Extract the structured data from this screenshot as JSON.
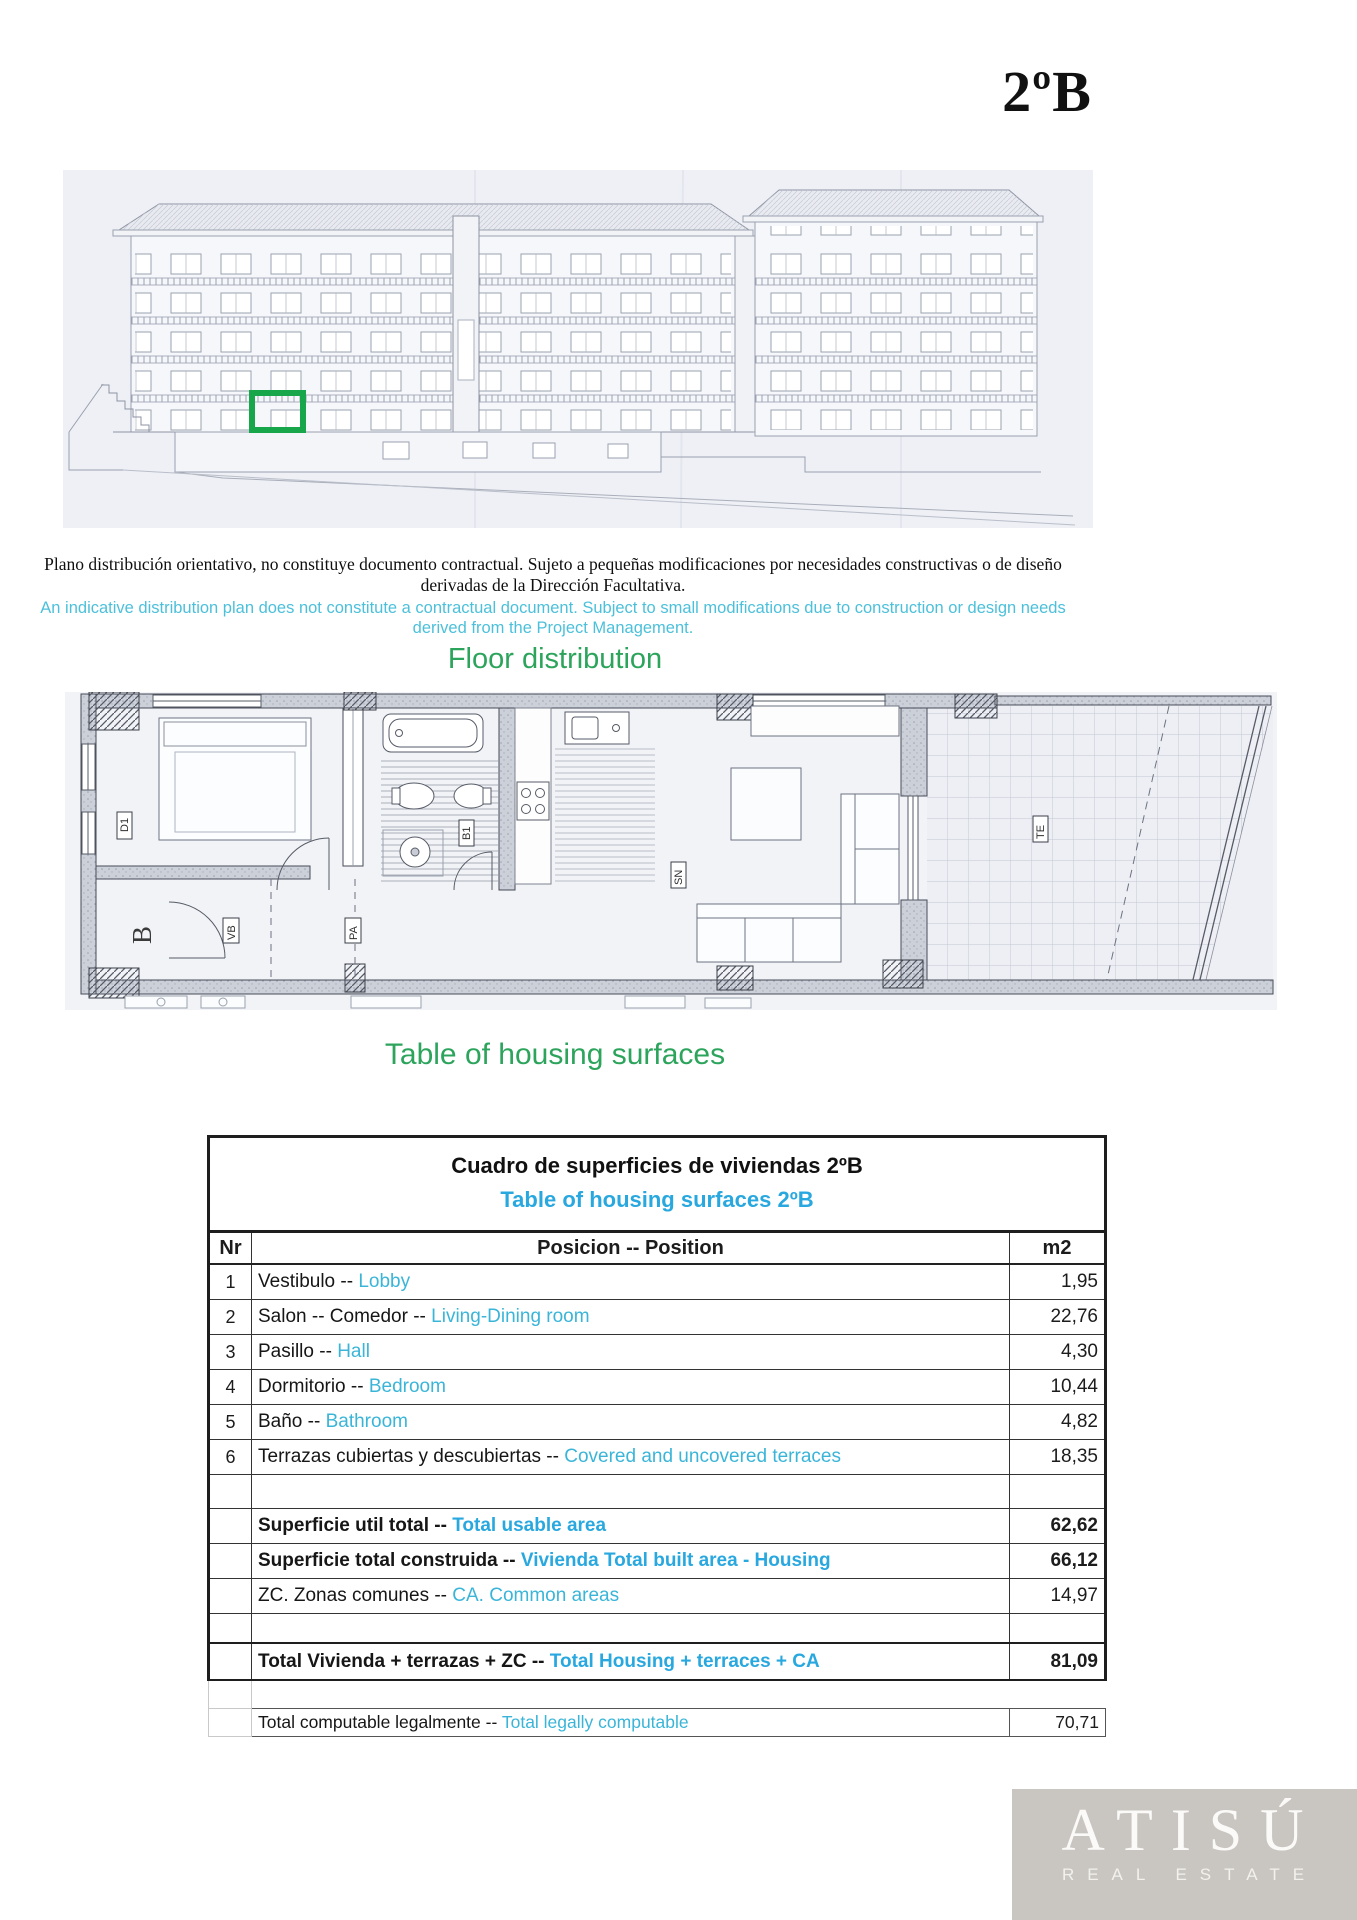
{
  "title": "2ºB",
  "disclaimer": {
    "es": "Plano distribución orientativo, no constituye documento contractual. Sujeto a pequeñas modificaciones por necesidades constructivas o de diseño derivadas de la Dirección Facultativa.",
    "en": "An indicative distribution plan does not constitute a contractual document. Subject to small modifications due to construction or design needs derived from the Project Management."
  },
  "headings": {
    "floor_distribution": "Floor distribution",
    "housing_surfaces": "Table of housing surfaces"
  },
  "plan_labels": {
    "block": "B",
    "d1": "D1",
    "b1": "B1",
    "vb": "VB",
    "pa": "PA",
    "sn": "SN",
    "te": "TE"
  },
  "colors": {
    "heading_green": "#2ca45c",
    "highlight_green": "#17a64a",
    "table_cyan": "#29a8df",
    "row_cyan": "#3ab5d8",
    "note_cyan": "#4cc0da"
  },
  "table": {
    "title_es": "Cuadro de superficies de viviendas 2ºB",
    "title_en": "Table of housing surfaces 2ºB",
    "headers": {
      "nr": "Nr",
      "position": "Posicion -- Position",
      "area": "m2"
    },
    "rows": [
      {
        "nr": "1",
        "es": "Vestibulo -- ",
        "en": "Lobby",
        "m2": "1,95"
      },
      {
        "nr": "2",
        "es": "Salon -- Comedor --  ",
        "en": "Living-Dining room",
        "m2": "22,76"
      },
      {
        "nr": "3",
        "es": "Pasillo -- ",
        "en": "Hall",
        "m2": "4,30"
      },
      {
        "nr": "4",
        "es": "Dormitorio  -- ",
        "en": "Bedroom",
        "m2": "10,44"
      },
      {
        "nr": "5",
        "es": "Baño  -- ",
        "en": "Bathroom",
        "m2": "4,82"
      },
      {
        "nr": "6",
        "es": "Terrazas cubiertas y descubiertas -- ",
        "en": "Covered and uncovered terraces",
        "m2": "18,35"
      }
    ],
    "summary": [
      {
        "es": "Superficie util total -- ",
        "en": "Total usable area",
        "m2": "62,62"
      },
      {
        "es": "Superficie total construida -- ",
        "en": "Vivienda Total built area - Housing",
        "m2": "66,12"
      },
      {
        "es": "ZC. Zonas comunes  -- ",
        "en": "CA. Common areas",
        "m2": "14,97"
      }
    ],
    "total": {
      "es": "Total Vivienda + terrazas + ZC  -- ",
      "en": "Total Housing + terraces + CA",
      "m2": "81,09"
    },
    "legal": {
      "es": "Total computable legalmente -- ",
      "en": "Total legally computable",
      "m2": "70,71"
    }
  },
  "footer": {
    "brand": "ATISÚ",
    "tagline": "REAL ESTATE"
  }
}
